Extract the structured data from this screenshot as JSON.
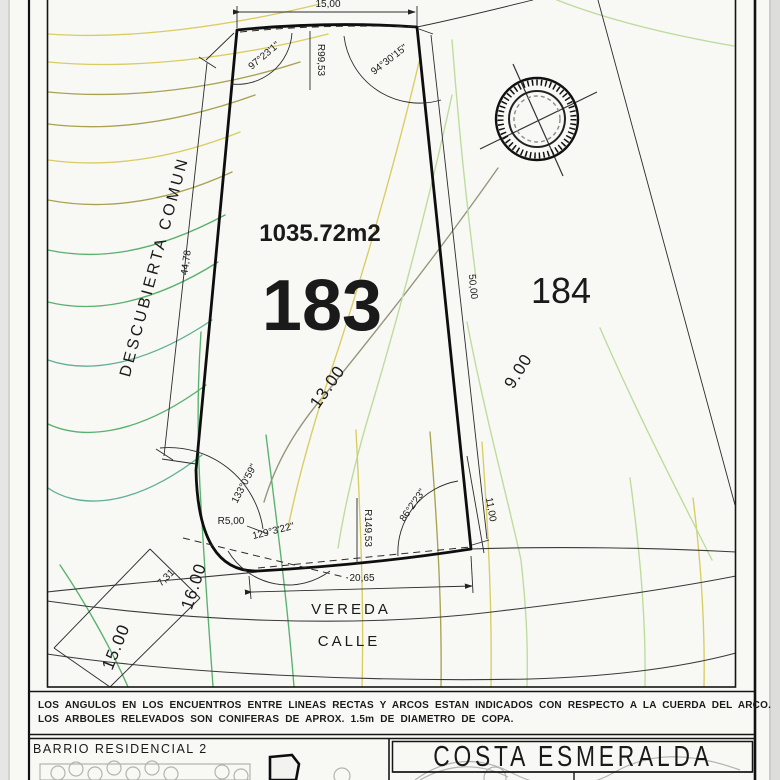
{
  "colors": {
    "paper": "#f8f8f5",
    "ink": "#1a1a1a",
    "contour_green": "#58b16c",
    "contour_pale": "#bcdc9c",
    "contour_yellow": "#d8cd62",
    "contour_olive": "#a9a252",
    "contour_teal": "#5fb096",
    "contour_grey": "#97947a",
    "map_grey": "#b4b4b0"
  },
  "survey": {
    "lot_main": {
      "number": "183",
      "area": "1035.72m2"
    },
    "lot_adjacent": {
      "number": "184"
    },
    "zones": {
      "common": "DESCUBIERTA COMUN",
      "sidewalk": "VEREDA",
      "street": "CALLE"
    },
    "dimensions": {
      "top": "15,00",
      "left": "44,78",
      "right": "50,00",
      "right_lower": "11,00",
      "bottom": "20,65",
      "corner": "7,31"
    },
    "radii": {
      "top": "R99,53",
      "corner": "R5,00",
      "bottom": "R149,53"
    },
    "angles": {
      "top_left": "97°23'1\"",
      "top_right": "94°30'15\"",
      "corner_upper": "133°0'59\"",
      "corner_lower": "129°3'22\"",
      "bottom_right": "86°2'23\""
    },
    "contour_labels": {
      "c13": "13.00",
      "c9": "9.00",
      "c16": "16.00",
      "c15": "15.00"
    }
  },
  "notes": {
    "line1": "LOS ANGULOS EN LOS ENCUENTROS ENTRE LINEAS RECTAS Y ARCOS ESTAN INDICADOS CON RESPECTO A LA CUERDA DEL ARCO.",
    "line2": "LOS ARBOLES RELEVADOS SON CONIFERAS DE APROX. 1.5m DE DIAMETRO DE COPA."
  },
  "titleblock": {
    "neighborhood": "BARRIO RESIDENCIAL 2",
    "project": "COSTA ESMERALDA"
  }
}
